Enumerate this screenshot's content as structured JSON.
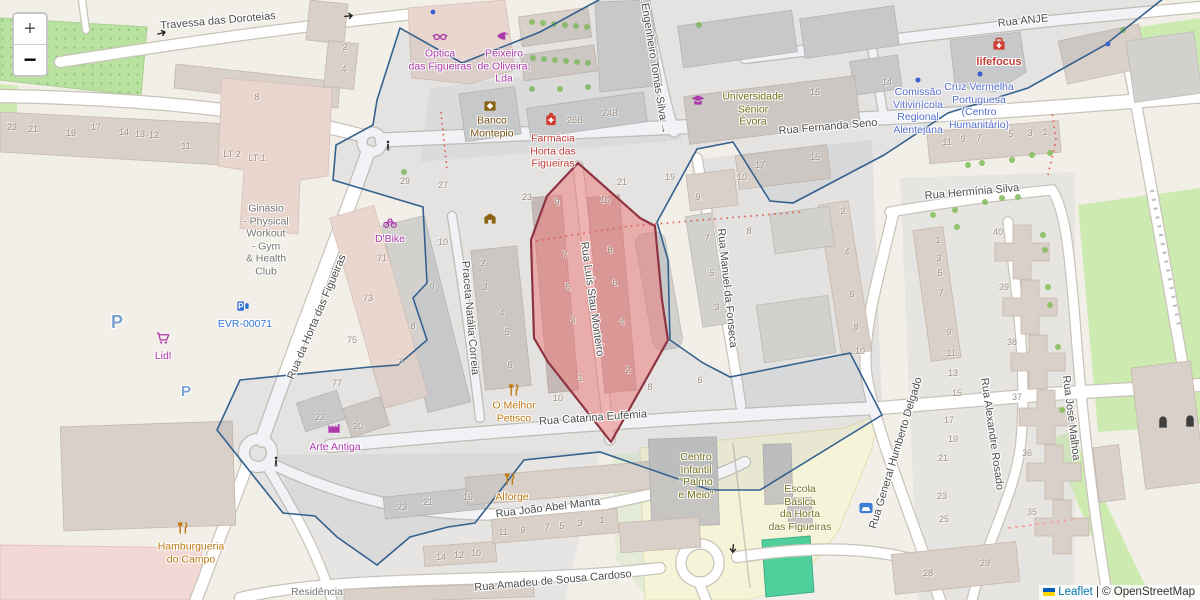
{
  "map": {
    "controls": {
      "zoom_in": "+",
      "zoom_out": "−"
    },
    "attribution": {
      "leaflet": "Leaflet",
      "separator": " | ",
      "osm": "© OpenStreetMap"
    },
    "colors": {
      "street": "#4d4d4d",
      "house_number": "#9e9186",
      "shop": "#ac39ac",
      "amenity": "#7a5413",
      "health": "#c23c36",
      "education": "#77731c",
      "office": "#5570cf",
      "food": "#bf7a12",
      "charging": "#3273de",
      "parking": "#7aa2cf",
      "gray": "#757575",
      "selection_fill": "#eb7876",
      "selection_border": "#8e3342",
      "boundary": "#35618e",
      "link": "#0078a8"
    },
    "streets": [
      {
        "name": "Travessa das Doroteias",
        "x": 218,
        "y": 21,
        "rot": -5
      },
      {
        "name": "Rua ANJE",
        "x": 1023,
        "y": 21,
        "rot": -6
      },
      {
        "name": "Rua Fernanda Seno",
        "x": 828,
        "y": 127,
        "rot": -5
      },
      {
        "name": "a Engenheiro Tomás Silva →",
        "x": 654,
        "y": 64,
        "rot": 81
      },
      {
        "name": "Rua Hermínia Silva",
        "x": 972,
        "y": 192,
        "rot": -5
      },
      {
        "name": "Rua da Horta das Figueiras",
        "x": 317,
        "y": 317,
        "rot": -67
      },
      {
        "name": "Praceta Natália Correia",
        "x": 470,
        "y": 318,
        "rot": 85
      },
      {
        "name": "Rua Luís Stau Monteiro",
        "x": 592,
        "y": 299,
        "rot": 82
      },
      {
        "name": "Rua Manuel da Fonseca",
        "x": 727,
        "y": 288,
        "rot": 84
      },
      {
        "name": "Rua Catarina Eufémia",
        "x": 593,
        "y": 418,
        "rot": -4
      },
      {
        "name": "Rua João Abel Manta",
        "x": 548,
        "y": 508,
        "rot": -7
      },
      {
        "name": "Rua Amadeu de Sousa Cardoso",
        "x": 553,
        "y": 581,
        "rot": -5
      },
      {
        "name": "Rua General Humberto Delgado",
        "x": 896,
        "y": 453,
        "rot": -73
      },
      {
        "name": "Rua Alexandre Rosado",
        "x": 992,
        "y": 434,
        "rot": 82
      },
      {
        "name": "Rua José Malhoa",
        "x": 1071,
        "y": 418,
        "rot": 83
      }
    ],
    "pois": [
      {
        "id": "optica",
        "lines": [
          "Óptica",
          "das Figueiras"
        ],
        "x": 440,
        "y": 60,
        "color": "shop",
        "icon": "glasses-icon",
        "icon_x": 440,
        "icon_y": 36
      },
      {
        "id": "peixeiro",
        "lines": [
          "Peixeiro",
          "de Oliveira,",
          "Lda"
        ],
        "x": 504,
        "y": 66,
        "color": "shop",
        "icon": "seafood-icon",
        "icon_x": 503,
        "icon_y": 36
      },
      {
        "id": "banco-montepio",
        "lines": [
          "Banco",
          "Montepio"
        ],
        "x": 492,
        "y": 127,
        "color": "amenity",
        "icon": "bank-icon",
        "icon_x": 490,
        "icon_y": 106
      },
      {
        "id": "farmacia",
        "lines": [
          "Farmácia",
          "Horta das",
          "Figueiras"
        ],
        "x": 553,
        "y": 151,
        "color": "health",
        "icon": "pharmacy-icon",
        "icon_x": 551,
        "icon_y": 119
      },
      {
        "id": "universidade",
        "lines": [
          "Universidade",
          "Sénior",
          "Évora"
        ],
        "x": 753,
        "y": 109,
        "color": "education",
        "icon": "university-icon",
        "icon_x": 698,
        "icon_y": 101
      },
      {
        "id": "comissao",
        "lines": [
          "Comissão",
          "Vitivinícola",
          "Regional",
          "Alentejana"
        ],
        "x": 918,
        "y": 111,
        "color": "office",
        "icon": "poi-dot-icon",
        "icon_x": 918,
        "icon_y": 80
      },
      {
        "id": "cruz-vermelha",
        "lines": [
          "Cruz Vermelha",
          "Portuguesa",
          "(Centro",
          "Humanitário)"
        ],
        "x": 979,
        "y": 106,
        "color": "office",
        "icon": "poi-dot-icon",
        "icon_x": 980,
        "icon_y": 74
      },
      {
        "id": "lifefocus",
        "lines": [
          "lifefocus"
        ],
        "x": 999,
        "y": 62,
        "color": "health",
        "bold": true,
        "icon": "first-aid-icon",
        "icon_x": 999,
        "icon_y": 44
      },
      {
        "id": "ginasio",
        "lines": [
          "Ginásio",
          "- Physical",
          "Workout",
          "- Gym",
          "& Health",
          "Club"
        ],
        "x": 266,
        "y": 240,
        "color": "gray"
      },
      {
        "id": "dbike",
        "lines": [
          "D'Bike"
        ],
        "x": 390,
        "y": 239,
        "color": "shop",
        "icon": "bicycle-icon",
        "icon_x": 390,
        "icon_y": 222
      },
      {
        "id": "evr",
        "lines": [
          "EVR-00071"
        ],
        "x": 245,
        "y": 324,
        "color": "charging",
        "icon": "charging-icon",
        "icon_x": 243,
        "icon_y": 306
      },
      {
        "id": "lidl",
        "lines": [
          "Lidl"
        ],
        "x": 163,
        "y": 356,
        "color": "shop",
        "icon": "cart-icon",
        "icon_x": 163,
        "icon_y": 338
      },
      {
        "id": "o-melhor-petisco",
        "lines": [
          "O Melhor",
          "Petisco"
        ],
        "x": 514,
        "y": 412,
        "color": "food",
        "icon": "restaurant-icon",
        "icon_x": 514,
        "icon_y": 390
      },
      {
        "id": "arte-antiga",
        "lines": [
          "Arte Antiga"
        ],
        "x": 335,
        "y": 447,
        "color": "shop",
        "icon": "workshop-icon",
        "icon_x": 334,
        "icon_y": 428
      },
      {
        "id": "alforge",
        "lines": [
          "Alforge"
        ],
        "x": 512,
        "y": 497,
        "color": "food",
        "icon": "restaurant-icon",
        "icon_x": 510,
        "icon_y": 479
      },
      {
        "id": "hamburgueria",
        "lines": [
          "Hamburgueria",
          "do Campo"
        ],
        "x": 191,
        "y": 553,
        "color": "food",
        "icon": "restaurant-icon",
        "icon_x": 183,
        "icon_y": 528
      },
      {
        "id": "centro-infantil",
        "lines": [
          "Centro",
          "Infantil",
          "\"Palmo",
          "e Meio\""
        ],
        "x": 696,
        "y": 476,
        "color": "education"
      },
      {
        "id": "escola-basica",
        "lines": [
          "Escola",
          "Básica",
          "da Horta",
          "das Figueiras"
        ],
        "x": 800,
        "y": 508,
        "color": "education"
      },
      {
        "id": "residencia",
        "lines": [
          "Residência"
        ],
        "x": 317,
        "y": 592,
        "color": "gray"
      },
      {
        "id": "parking-1",
        "lines": [
          "P"
        ],
        "x": 117,
        "y": 322,
        "color": "parking",
        "size": 18,
        "bold": true
      },
      {
        "id": "parking-2",
        "lines": [
          "P"
        ],
        "x": 186,
        "y": 392,
        "color": "parking",
        "size": 15,
        "bold": true
      }
    ],
    "icons": [
      {
        "icon": "pedestrian-crossing-icon",
        "x": 388,
        "y": 146
      },
      {
        "icon": "pedestrian-crossing-icon",
        "x": 276,
        "y": 462
      },
      {
        "icon": "oneway-arrow-icon",
        "x": 162,
        "y": 33,
        "rot": -15
      },
      {
        "icon": "oneway-arrow-icon",
        "x": 349,
        "y": 16,
        "rot": -5
      },
      {
        "icon": "oneway-arrow-icon",
        "x": 733,
        "y": 549,
        "rot": 95
      },
      {
        "icon": "poi-dot-icon",
        "x": 918,
        "y": 80
      },
      {
        "icon": "poi-dot-icon",
        "x": 980,
        "y": 74
      },
      {
        "icon": "poi-dot-icon",
        "x": 1108,
        "y": 44
      },
      {
        "icon": "poi-dot-icon",
        "x": 433,
        "y": 12
      },
      {
        "icon": "taxi-icon",
        "x": 866,
        "y": 508
      },
      {
        "icon": "building-entrance-icon",
        "x": 1163,
        "y": 422
      },
      {
        "icon": "building-entrance-icon",
        "x": 1190,
        "y": 421
      },
      {
        "icon": "school-icon",
        "x": 490,
        "y": 218
      }
    ],
    "house_numbers": [
      [
        12,
        127,
        "23"
      ],
      [
        33,
        129,
        "21"
      ],
      [
        71,
        133,
        "19"
      ],
      [
        96,
        127,
        "17"
      ],
      [
        124,
        132,
        "14"
      ],
      [
        140,
        134,
        "13"
      ],
      [
        154,
        135,
        "12"
      ],
      [
        186,
        146,
        "11"
      ],
      [
        232,
        154,
        "LT 2"
      ],
      [
        257,
        158,
        "LT 1"
      ],
      [
        257,
        97,
        "8"
      ],
      [
        345,
        47,
        "2"
      ],
      [
        344,
        69,
        "4"
      ],
      [
        405,
        181,
        "29"
      ],
      [
        443,
        185,
        "27"
      ],
      [
        527,
        197,
        "23"
      ],
      [
        622,
        182,
        "21"
      ],
      [
        670,
        177,
        "19"
      ],
      [
        557,
        202,
        "9"
      ],
      [
        605,
        200,
        "10"
      ],
      [
        565,
        255,
        "7"
      ],
      [
        610,
        250,
        "8"
      ],
      [
        568,
        287,
        "5"
      ],
      [
        615,
        283,
        "6"
      ],
      [
        573,
        320,
        "3"
      ],
      [
        622,
        322,
        "4"
      ],
      [
        580,
        378,
        "1"
      ],
      [
        628,
        370,
        "2"
      ],
      [
        558,
        398,
        "10"
      ],
      [
        650,
        387,
        "8"
      ],
      [
        700,
        380,
        "6"
      ],
      [
        483,
        263,
        "2"
      ],
      [
        485,
        287,
        "3"
      ],
      [
        502,
        313,
        "4"
      ],
      [
        507,
        332,
        "5"
      ],
      [
        510,
        365,
        "6"
      ],
      [
        382,
        258,
        "71"
      ],
      [
        368,
        298,
        "73"
      ],
      [
        352,
        340,
        "75"
      ],
      [
        337,
        383,
        "77"
      ],
      [
        443,
        242,
        "10"
      ],
      [
        432,
        287,
        "9"
      ],
      [
        413,
        326,
        "8"
      ],
      [
        400,
        362,
        "7"
      ],
      [
        698,
        197,
        "9"
      ],
      [
        742,
        177,
        "10"
      ],
      [
        760,
        165,
        "17"
      ],
      [
        815,
        157,
        "15"
      ],
      [
        749,
        231,
        "8"
      ],
      [
        815,
        92,
        "16"
      ],
      [
        887,
        82,
        "14"
      ],
      [
        575,
        120,
        "26B"
      ],
      [
        610,
        113,
        "24B"
      ],
      [
        947,
        142,
        "11"
      ],
      [
        963,
        139,
        "9"
      ],
      [
        979,
        138,
        "7"
      ],
      [
        1011,
        134,
        "5"
      ],
      [
        1030,
        133,
        "3"
      ],
      [
        1045,
        132,
        "1"
      ],
      [
        843,
        211,
        "2"
      ],
      [
        847,
        252,
        "4"
      ],
      [
        852,
        294,
        "6"
      ],
      [
        856,
        327,
        "8"
      ],
      [
        860,
        351,
        "10"
      ],
      [
        938,
        240,
        "1"
      ],
      [
        939,
        258,
        "3"
      ],
      [
        940,
        273,
        "5"
      ],
      [
        941,
        293,
        "7"
      ],
      [
        949,
        332,
        "9"
      ],
      [
        951,
        353,
        "11"
      ],
      [
        998,
        232,
        "40"
      ],
      [
        1004,
        287,
        "39"
      ],
      [
        1012,
        342,
        "38"
      ],
      [
        1017,
        397,
        "37"
      ],
      [
        1027,
        453,
        "36"
      ],
      [
        1032,
        512,
        "35"
      ],
      [
        953,
        373,
        "13"
      ],
      [
        957,
        393,
        "15"
      ],
      [
        949,
        420,
        "17"
      ],
      [
        953,
        439,
        "19"
      ],
      [
        943,
        458,
        "21"
      ],
      [
        942,
        496,
        "23"
      ],
      [
        944,
        519,
        "25"
      ],
      [
        928,
        573,
        "28"
      ],
      [
        985,
        563,
        "29"
      ],
      [
        707,
        238,
        "7"
      ],
      [
        712,
        273,
        "5"
      ],
      [
        717,
        307,
        "3"
      ],
      [
        320,
        417,
        "22"
      ],
      [
        358,
        426,
        "20"
      ],
      [
        402,
        507,
        "23"
      ],
      [
        428,
        502,
        "21"
      ],
      [
        468,
        497,
        "19"
      ],
      [
        503,
        532,
        "11"
      ],
      [
        523,
        530,
        "9"
      ],
      [
        547,
        527,
        "7"
      ],
      [
        562,
        526,
        "5"
      ],
      [
        580,
        523,
        "3"
      ],
      [
        602,
        520,
        "1"
      ],
      [
        441,
        557,
        "14"
      ],
      [
        459,
        555,
        "12"
      ],
      [
        476,
        553,
        "10"
      ]
    ]
  }
}
